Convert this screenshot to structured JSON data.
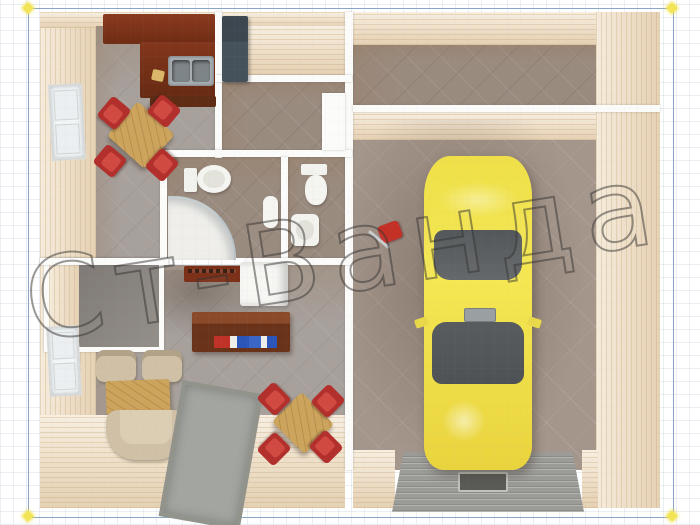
{
  "watermark": {
    "text": "Ст-Ванда"
  },
  "frame": {
    "border_color": "#8ba6c4",
    "handle_color": "#f3e455"
  },
  "palette": {
    "wall_wood": "#f1e2c9",
    "wall_top_white": "#fbfbf9",
    "kitchen_floor": "#a7a09b",
    "bathroom_floor": "#9a8b7f",
    "garage_floor": "#a5968b",
    "storage_floor": "#8e8882",
    "car_body_yellow": "#f0e14c",
    "car_glass": "#595d5f",
    "chair_red": "#b22f2b",
    "cabinet_mahogany": "#7c3018",
    "sofa_beige": "#cfc0a6",
    "table_wood": "#cda45c",
    "ramp_gray": "#9b9b97",
    "wardrobe_gray": "#46525b"
  },
  "objects": {
    "garage_vehicle": "yellow-car",
    "garage_tool": "red-floor-jack",
    "garage_exit": "ramp-with-pit-cover",
    "kitchen": [
      "cabinets",
      "double-sink",
      "dining-table",
      "red-chairs",
      "window"
    ],
    "bathroom_1": [
      "toilet",
      "corner-shower",
      "water-heater"
    ],
    "bathroom_2": [
      "toilet",
      "wash-basin"
    ],
    "living_room": [
      "sofa",
      "armchairs",
      "coffee-table",
      "desk-with-books",
      "fridge",
      "dining-set",
      "rug",
      "window"
    ],
    "entrance": [
      "wardrobe"
    ]
  }
}
